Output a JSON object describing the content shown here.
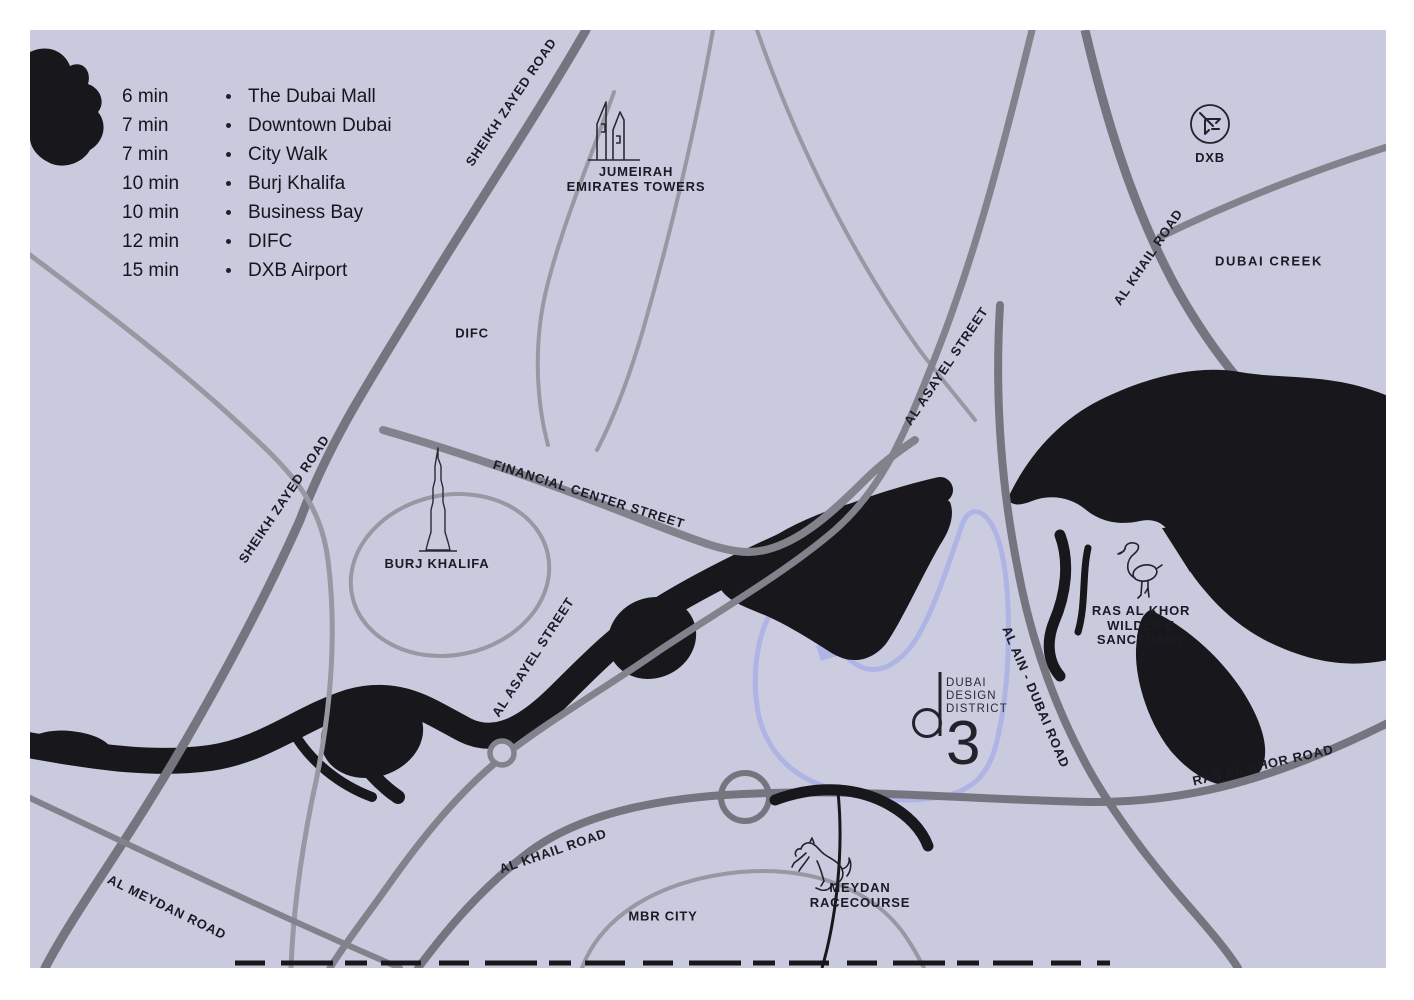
{
  "colors": {
    "frame": "#ffffff",
    "map_background": "#c9cadd",
    "water": "#18171c",
    "road_major": "#757580",
    "road_medium": "#82828d",
    "road_minor": "#9898a2",
    "district_outline": "#aeb4e4",
    "label_text": "#1b1b25"
  },
  "legend": {
    "items": [
      {
        "time": "6 min",
        "place": "The Dubai Mall"
      },
      {
        "time": "7 min",
        "place": "Downtown Dubai"
      },
      {
        "time": "7 min",
        "place": "City Walk"
      },
      {
        "time": "10 min",
        "place": "Burj Khalifa"
      },
      {
        "time": "10 min",
        "place": "Business Bay"
      },
      {
        "time": "12 min",
        "place": "DIFC"
      },
      {
        "time": "15 min",
        "place": "DXB Airport"
      }
    ]
  },
  "roads": {
    "sheikh_zayed_top": "SHEIKH ZAYED ROAD",
    "sheikh_zayed_left": "SHEIKH ZAYED ROAD",
    "al_khail_top": "AL KHAIL ROAD",
    "al_khail_bottom": "AL KHAIL ROAD",
    "al_asayel_upper": "AL ASAYEL STREET",
    "al_asayel_lower": "AL ASAYEL STREET",
    "financial_center": "FINANCIAL CENTER STREET",
    "al_ain_dubai": "AL AIN - DUBAI ROAD",
    "ras_al_khor_road": "RAS AL KHOR ROAD",
    "al_meydan": "AL MEYDAN ROAD"
  },
  "areas": {
    "difc": "DIFC",
    "dubai_creek": "DUBAI CREEK",
    "mbr_city": "MBR CITY"
  },
  "pois": {
    "jumeirah": {
      "line1": "JUMEIRAH",
      "line2": "EMIRATES TOWERS"
    },
    "airport": {
      "code": "DXB"
    },
    "burj": {
      "label": "BURJ KHALIFA"
    },
    "ras_al_khor": {
      "line1": "RAS AL KHOR",
      "line2": "WILDLIFE",
      "line3": "SANCTUARY"
    },
    "meydan": {
      "line1": "MEYDAN",
      "line2": "RACECOURSE"
    }
  },
  "logo": {
    "line1": "DUBAI",
    "line2": "DESIGN",
    "line3": "DISTRICT",
    "numeral": "3"
  }
}
